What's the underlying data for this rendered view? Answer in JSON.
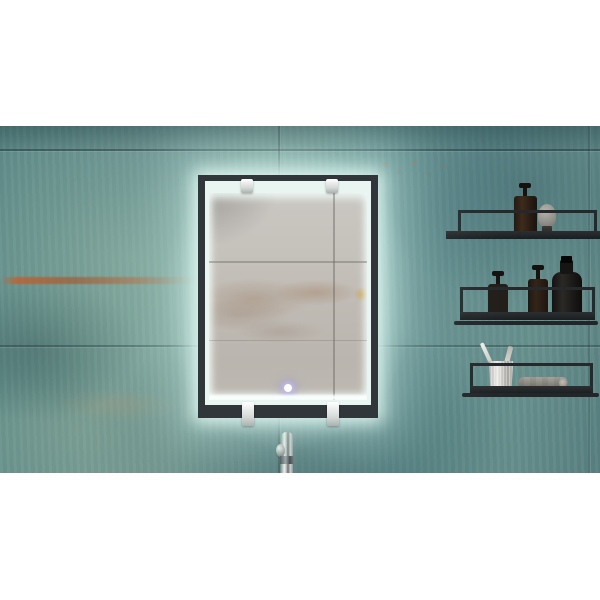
{
  "scene": {
    "type": "interior-product-photo",
    "setting": "Backlit LED bathroom mirror on a teal patina tiled wall, letterboxed on a white page",
    "aria": {
      "photo": "Bathroom wall in weathered teal patina tiles with a glowing black-framed LED mirror, three black metal shelves holding toiletries on the right, and a chrome faucet below the mirror",
      "wall": "Teal-green oxidized metal-look tile wall with rust streaks and seams",
      "mirror": "Rectangular black-framed mirror with cool-white LED backlight halo, reflecting a grey concrete wall",
      "touch_button": "Small round glowing touch sensor at the bottom center of the mirror glass",
      "faucet": "Chrome single-lever basin faucet partially visible below the mirror",
      "shelf_top": "Black metal rail shelf holding an amber pump soap dispenser with a white label and a grey shaving brush",
      "shelf_middle": "Black metal rail shelf holding a small labeled pump bottle, a taller amber pump bottle and a large dark apothecary bottle with a big white label",
      "shelf_bottom": "Black metal rail shelf holding a brushed metal tumbler with two toothbrushes and a rolled grey towel",
      "clips": "Chrome mounting clips on the top and bottom edges of the mirror frame"
    },
    "objects": [
      "led-mirror",
      "touch-sensor",
      "chrome-faucet",
      "amber-pump-bottle",
      "shaving-brush",
      "small-pump-bottle",
      "tall-pump-bottle",
      "apothecary-bottle",
      "metal-tumbler",
      "toothbrush",
      "toothbrush",
      "rolled-towel"
    ],
    "colors": {
      "letterbox": "#ffffff",
      "wall_teal": "#6a938e",
      "wall_dark_teal": "#3f696d",
      "rust": "#b05c2a",
      "mirror_frame": "#31363a",
      "led_glow": "#e9f5f1",
      "reflection_concrete": "#c2beb8",
      "touch_glow": "#9896dc",
      "shelf_metal": "#26292b",
      "bottle_amber": "#3d2c1d",
      "bottle_dark": "#1c1a18",
      "label_white": "#e8e5de",
      "brush_grey": "#8e8d87",
      "chrome": "#d9d9d7",
      "towel_grey": "#918e88"
    }
  }
}
